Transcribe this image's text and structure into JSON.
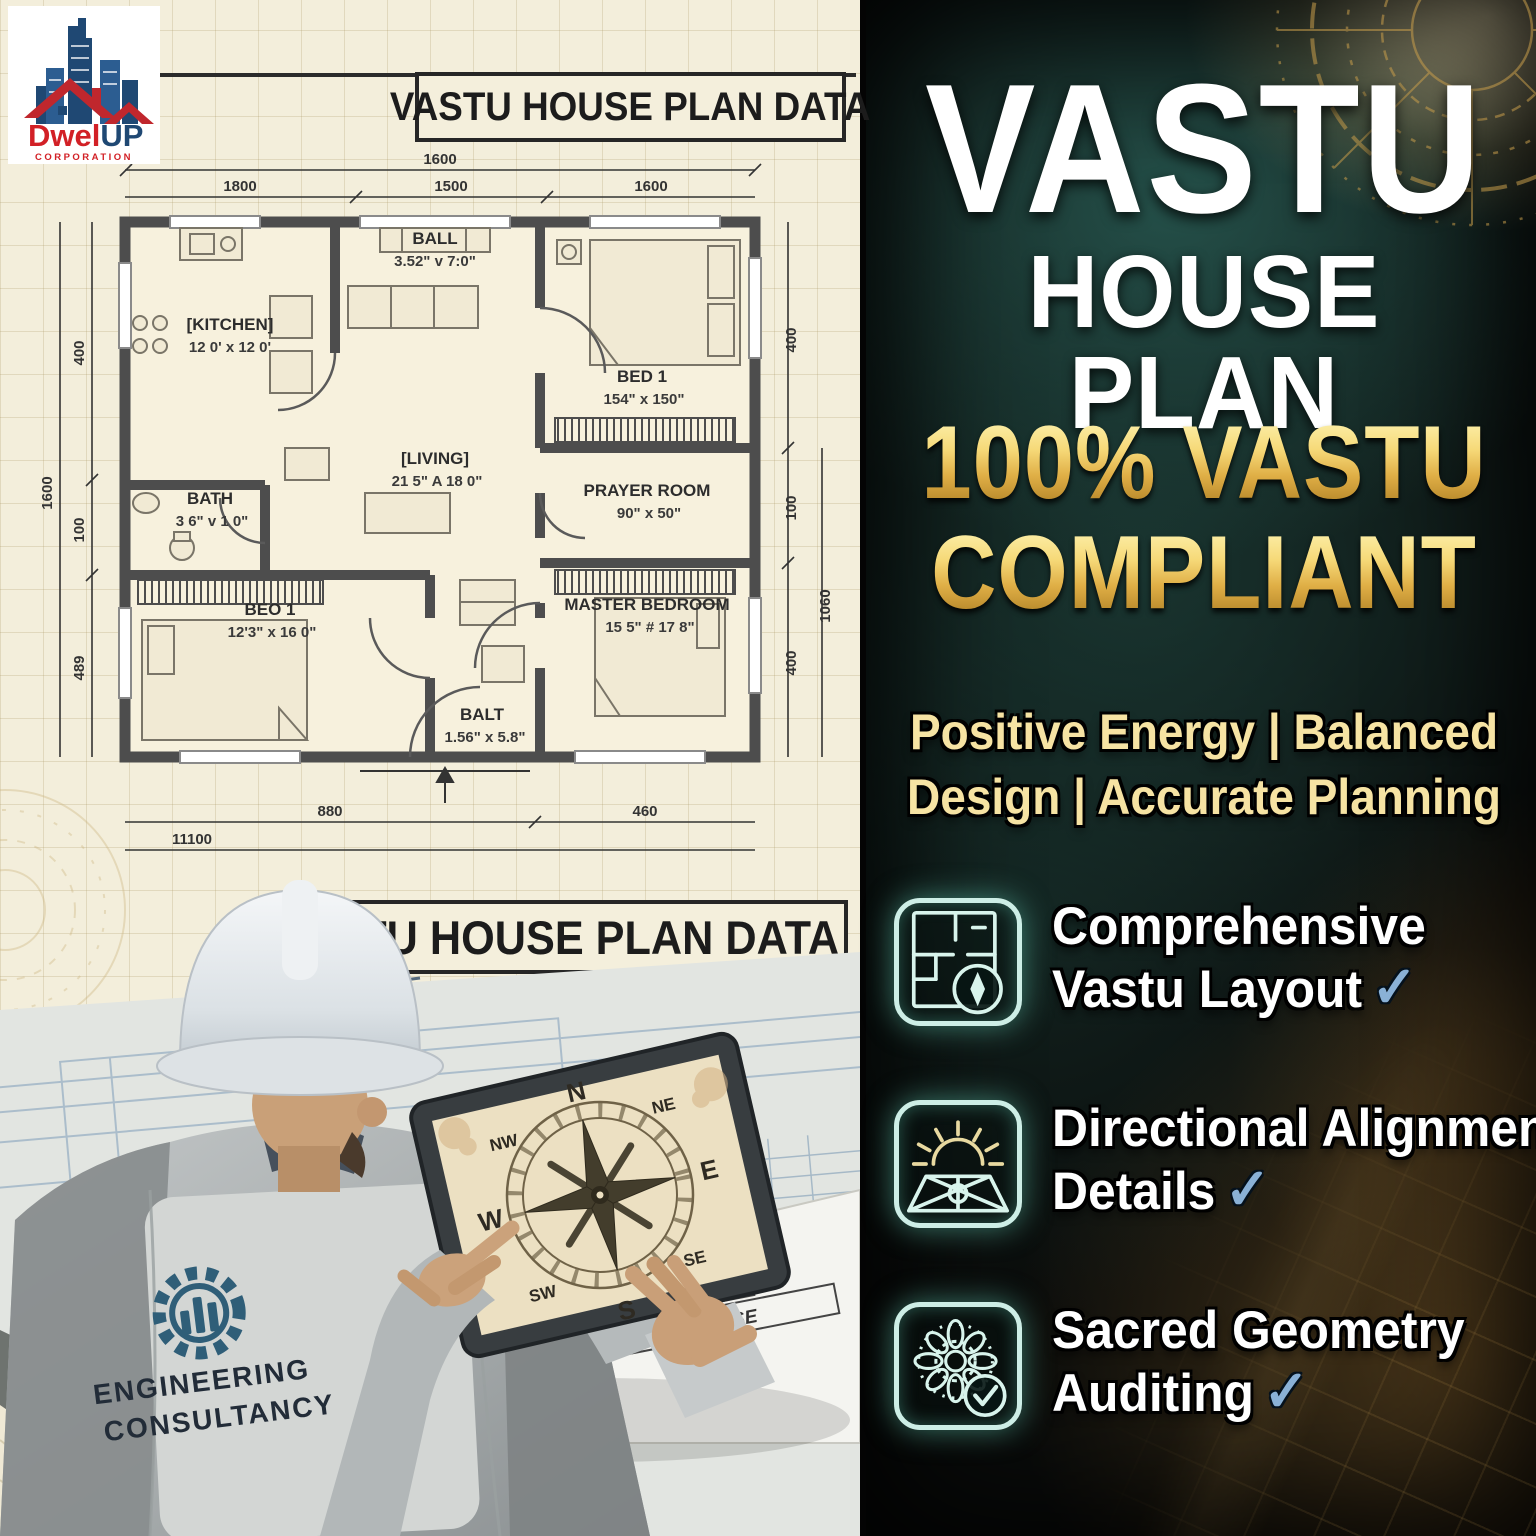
{
  "logo": {
    "brand_red": "Dwel",
    "brand_blue": "UP",
    "subtitle": "CORPORATION"
  },
  "plan": {
    "title_top": "VASTU HOUSE PLAN DATA",
    "title_bottom": "VASTU HOUSE PLAN DATA",
    "sheet_title": "VABTU HOUSE",
    "rooms": {
      "kitchen": {
        "name": "[KITCHEN]",
        "size": "12 0' x 12 0'"
      },
      "hall": {
        "name": "BALL",
        "size": "3.52\" v 7:0\""
      },
      "bed1": {
        "name": "BED 1",
        "size": "154\" x 150\""
      },
      "bath": {
        "name": "BATH",
        "size": "3 6\" v 1 0\""
      },
      "living": {
        "name": "[LIVING]",
        "size": "21 5\" A 18 0\""
      },
      "prayer": {
        "name": "PRAYER ROOM",
        "size": "90\" x 50\""
      },
      "bed2": {
        "name": "BEO 1",
        "size": "12'3\" x 16 0\""
      },
      "master": {
        "name": "MASTER BEDROOM",
        "size": "15 5\" # 17 8\""
      },
      "balt": {
        "name": "BALT",
        "size": "1.56\" x 5.8\""
      }
    },
    "dims": {
      "top_overall": "1600",
      "top_seg1": "1800",
      "top_seg2": "1500",
      "top_seg3": "1600",
      "left_overall": "1600",
      "left_seg1": "400",
      "left_seg2": "100",
      "left_seg3": "489",
      "right_seg1": "400",
      "right_seg2": "100",
      "right_overall": "1060",
      "right_seg3": "400",
      "bottom_seg1": "880",
      "bottom_seg2": "460",
      "bottom_overall": "11100"
    }
  },
  "compass": {
    "n": "N",
    "ne": "NE",
    "e": "E",
    "se": "SE",
    "s": "S",
    "sw": "SW",
    "w": "W",
    "nw": "NW"
  },
  "engineer": {
    "vest_line1": "ENGINEERING",
    "vest_line2": "CONSULTANCY"
  },
  "right_panel": {
    "title_line1": "VASTU",
    "title_line2": "HOUSE PLAN",
    "gold_line1": "100% VASTU",
    "gold_line2": "COMPLIANT",
    "tagline_line1": "Positive Energy | Balanced",
    "tagline_line2": "Design | Accurate Planning",
    "features": [
      {
        "line1": "Comprehensive",
        "line2": "Vastu Layout",
        "check": "✓"
      },
      {
        "line1": "Directional Alignment",
        "line2": "Details",
        "check": "✓"
      },
      {
        "line1": "Sacred Geometry",
        "line2": "Auditing",
        "check": "✓"
      }
    ]
  },
  "colors": {
    "gold": "#e8c25a",
    "teal_glow": "#2a5a52",
    "check_blue": "#8ab1d6",
    "cream": "#f3eedb",
    "wall": "#4d4d4d",
    "logo_red": "#d22026",
    "logo_blue": "#1f4873"
  }
}
